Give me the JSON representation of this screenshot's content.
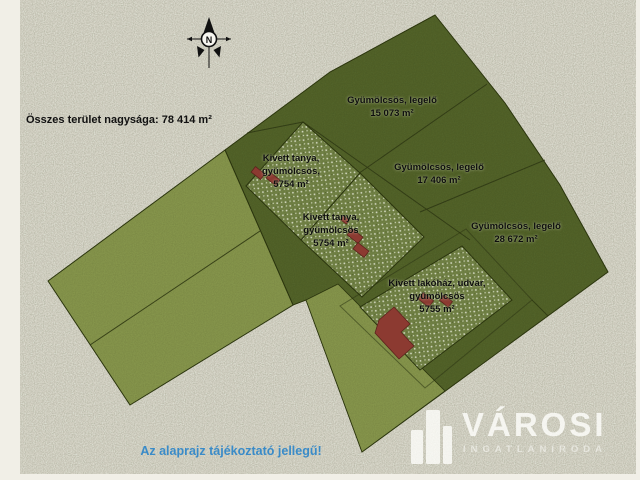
{
  "title": "Összes terület nagysága: 78 414 m²",
  "note": "Az alaprajz tájékoztató jellegű!",
  "compass": {
    "label": "N"
  },
  "logo": {
    "name": "VÁROSI",
    "subtitle": "INGATLANIRODA"
  },
  "parcels": [
    {
      "id": "parcel-15073",
      "line1": "Gyümölcsös, legelő",
      "line2": "",
      "area": "15 073 m²"
    },
    {
      "id": "parcel-17406",
      "line1": "Gyümölcsös, legelő",
      "line2": "",
      "area": "17 406 m²"
    },
    {
      "id": "parcel-28672",
      "line1": "Gyümölcsös, legelő",
      "line2": "",
      "area": "28 672 m²"
    },
    {
      "id": "parcel-tanya-1",
      "line1": "Kivett tanya,",
      "line2": "gyümölcsös,",
      "area": "5754 m²"
    },
    {
      "id": "parcel-tanya-2",
      "line1": "Kivett tanya,",
      "line2": "gyümölcsös",
      "area": "5754 m²"
    },
    {
      "id": "parcel-lakohaz",
      "line1": "Kivett lakóház, udvar,",
      "line2": "gyümölcsös",
      "area": "5755 m²"
    }
  ],
  "colors": {
    "background": "#f1efe7",
    "field_dark": "#57672e",
    "field_light": "#8d9d51",
    "orchard_base": "#78894b",
    "boundary": "#2e3916",
    "building_red": "#8c3a31",
    "note_blue": "#3a8bc8",
    "text_black": "#0d0d0d"
  }
}
